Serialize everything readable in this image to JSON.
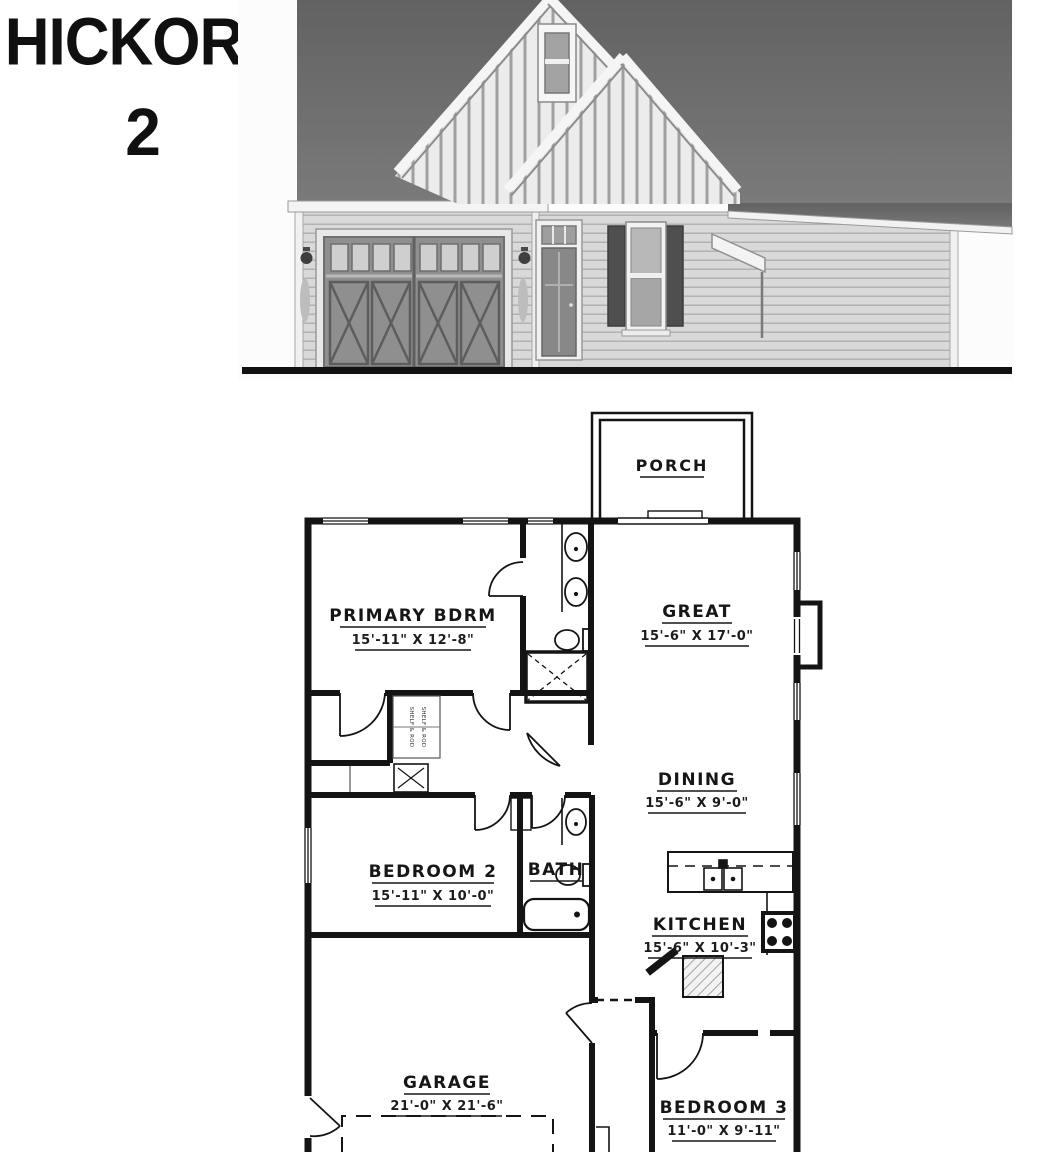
{
  "title": {
    "name": "HICKORY",
    "number": "2"
  },
  "plan": {
    "porch_label": "PORCH",
    "closet_note": "SHELF & ROD",
    "rooms": {
      "primary": {
        "name": "PRIMARY BDRM",
        "dims": "15'-11\" X 12'-8\""
      },
      "great": {
        "name": "GREAT",
        "dims": "15'-6\" X 17'-0\""
      },
      "dining": {
        "name": "DINING",
        "dims": "15'-6\" X 9'-0\""
      },
      "bedroom2": {
        "name": "BEDROOM 2",
        "dims": "15'-11\" X 10'-0\""
      },
      "bath": {
        "name": "BATH"
      },
      "kitchen": {
        "name": "KITCHEN",
        "dims": "15'-6\" X 10'-3\""
      },
      "garage": {
        "name": "GARAGE",
        "dims": "21'-0\" X 21'-6\""
      },
      "bedroom3": {
        "name": "BEDROOM 3",
        "dims": "11'-0\" X 9'-11\""
      }
    }
  },
  "colors": {
    "roof": "#6a6a6a",
    "siding": "#d8d8d8",
    "board_batten": "#ececec",
    "wall_line": "#141414",
    "ground_line": "#111111"
  }
}
